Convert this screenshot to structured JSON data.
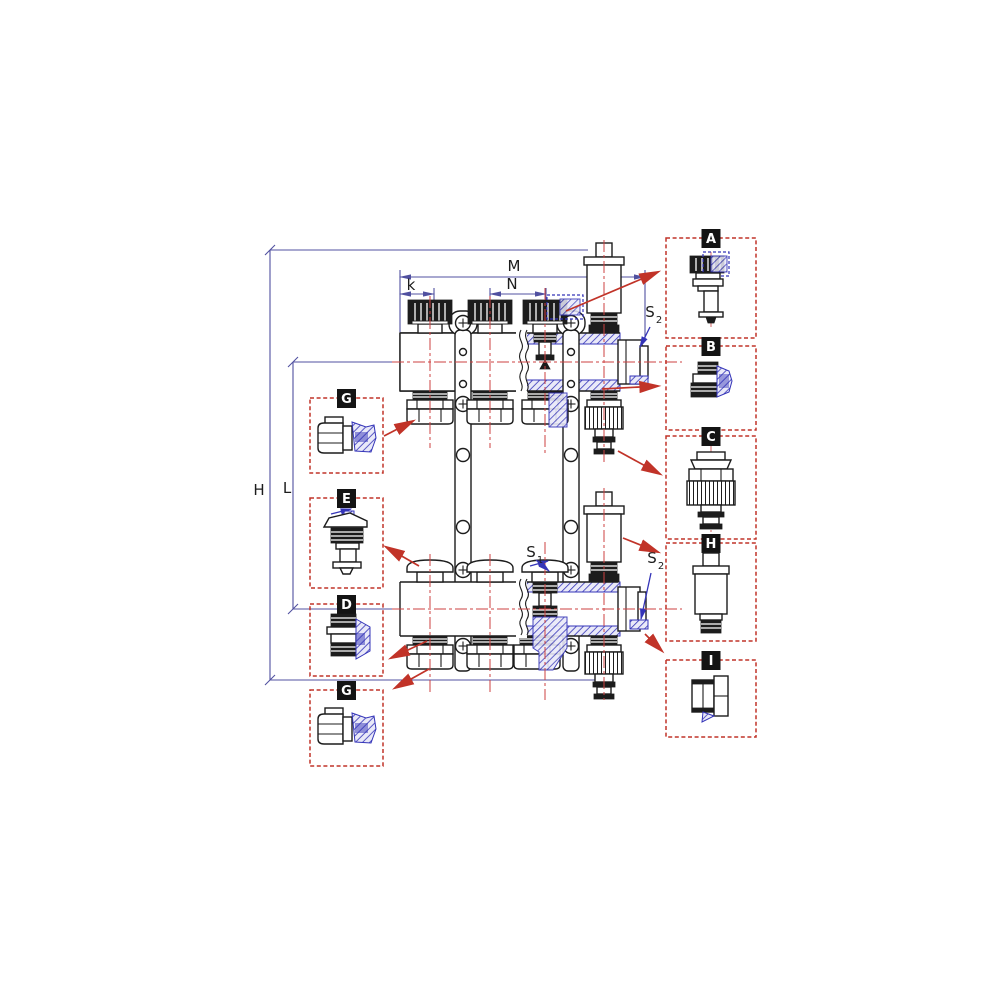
{
  "diagram": {
    "dimension_labels": {
      "h": "H",
      "l": "L",
      "m": "M",
      "n": "N",
      "k": "k",
      "s_base": "S",
      "s1_sub": "1",
      "s2_sub": "2"
    },
    "callout_labels": {
      "a": "A",
      "b": "B",
      "c": "C",
      "d": "D",
      "e": "E",
      "g1": "G",
      "g2": "G",
      "h": "H",
      "i": "I"
    },
    "colors": {
      "background": "#ffffff",
      "line": "#1c1c1c",
      "section_blue": "#3434b8",
      "dimension_blue": "#5050a0",
      "centerline_red": "#cc4040",
      "callout_red": "#c13328",
      "callout_label_bg": "#141414",
      "callout_label_text": "#ffffff"
    }
  }
}
